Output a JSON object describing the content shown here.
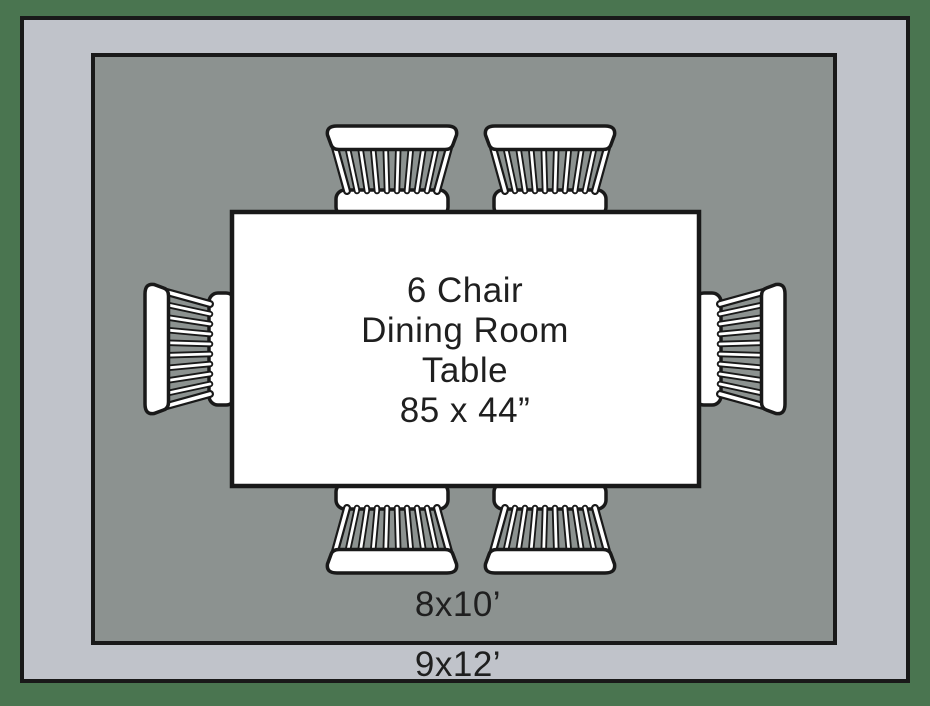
{
  "title": "6 chair dining room table rug size diagram",
  "colors": {
    "background": "#4a7550",
    "outer_rug": "#c0c3ca",
    "inner_rug": "#8c9290",
    "table_fill": "#ffffff",
    "outline": "#191919",
    "text": "#1f1f1f"
  },
  "table": {
    "lines": [
      "6 Chair",
      "Dining Room",
      "Table",
      "85 x 44”"
    ],
    "size_label": "85 x 44”"
  },
  "rugs": {
    "inner": {
      "label": "8x10’"
    },
    "outer": {
      "label": "9x12’"
    }
  },
  "chairs": {
    "count": 6,
    "style": "windsor-top-view",
    "positions": [
      "top-left",
      "top-right",
      "right",
      "bottom-right",
      "bottom-left",
      "left"
    ]
  }
}
